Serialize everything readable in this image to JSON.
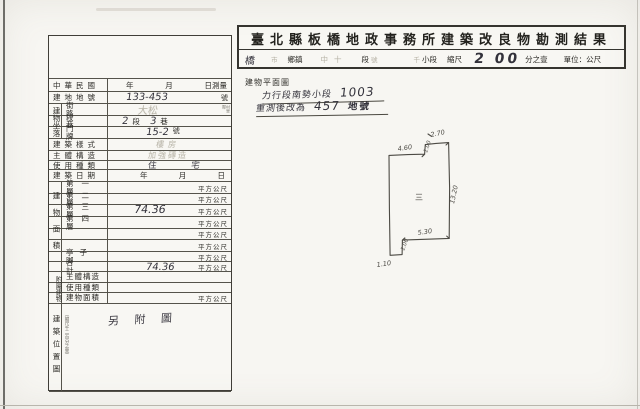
{
  "colors": {
    "paper": "#f7f6f2",
    "ink": "#2b2a26",
    "handwriting": "#33323b",
    "faint": "#b5b1a4",
    "line": "#403e38"
  },
  "header": {
    "title": "臺北縣板橋地政事務所建築改良物勘測結果",
    "scale": [
      {
        "t": "橋"
      },
      {
        "t": "市"
      },
      {
        "t": "鄉鎮"
      },
      {
        "t": "中十"
      },
      {
        "t": "段"
      },
      {
        "t": "號"
      },
      {
        "t": "千"
      },
      {
        "t": "小段"
      },
      {
        "t": "縮尺"
      },
      {
        "t": "2 00"
      },
      {
        "t": "分之壹"
      },
      {
        "t": "單位：公尺"
      }
    ]
  },
  "form": {
    "row_cn": {
      "label": "中華民國",
      "y": "年",
      "m": "月",
      "d": "日測量"
    },
    "row_lot": {
      "label": "建地地號",
      "hand": "133-453",
      "suffix": "號"
    },
    "loc": {
      "side": "建物坐落",
      "street": {
        "label": "街路",
        "hand": "大松",
        "note": "村里鄰"
      },
      "lane": {
        "label": "段巷",
        "h1": "2",
        "p1": "段",
        "h2": "3",
        "p2": "巷"
      },
      "door": {
        "label": "門牌",
        "hand": "15-2",
        "suffix": "號"
      }
    },
    "row_style": {
      "label": "建築樣式",
      "hand": "樓房"
    },
    "row_struct": {
      "label": "主體構造",
      "hand": "加強磚造"
    },
    "row_use": {
      "label": "使用種類",
      "hand": "住 宅"
    },
    "row_date": {
      "label": "建築日期",
      "y": "年",
      "m": "月",
      "d": "日"
    },
    "area": {
      "side": "建物面積",
      "unit": "平方公尺",
      "rows": [
        {
          "label": "第一層",
          "hand": ""
        },
        {
          "label": "第二層",
          "hand": ""
        },
        {
          "label": "第三層",
          "hand": "74.36"
        },
        {
          "label": "第四層",
          "hand": ""
        },
        {
          "label": "",
          "hand": ""
        },
        {
          "label": "",
          "hand": ""
        },
        {
          "label": "亭子脚",
          "hand": ""
        },
        {
          "label": "合計",
          "hand": "74.36"
        }
      ]
    },
    "annex": {
      "side": "附屬建物",
      "unit": "平方公尺",
      "rows": [
        {
          "label": "主體構造"
        },
        {
          "label": "使用種類"
        },
        {
          "label": "建物面積"
        }
      ]
    },
    "pos": {
      "side": "建築位置圖",
      "note": "（縮尺千二百分之壹）",
      "hand": "另 附 圖"
    }
  },
  "plan": {
    "label": "建物平面圖",
    "note1": {
      "text": "力行段南勢小段",
      "num": "1003"
    },
    "note2": {
      "text": "重測後改為",
      "num": "457",
      "suffix": "地號"
    },
    "sketch": {
      "center": "三",
      "dims": {
        "top_left": "4.60",
        "top_step": "1.00",
        "top_right": "2.70",
        "right": "13.20",
        "bottom": "5.30",
        "bottom_step": "1.00",
        "bottom_left": "1.10"
      }
    }
  }
}
